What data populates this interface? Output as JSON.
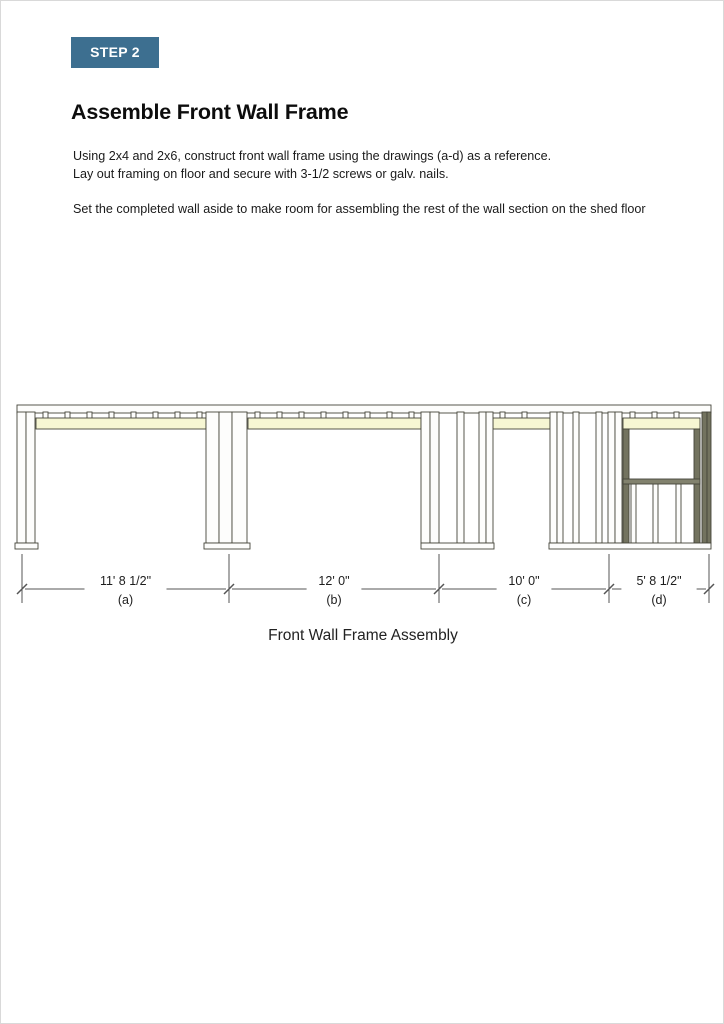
{
  "page": {
    "badge": "STEP 2",
    "title": "Assemble Front Wall Frame",
    "para1_line1": "Using 2x4 and 2x6, construct front wall frame using the drawings (a-d) as a reference.",
    "para1_line2": "Lay out framing on floor and secure with 3-1/2 screws or galv. nails.",
    "para2": "Set the completed wall aside to make room for assembling the rest of the wall section on the shed floor",
    "caption": "Front Wall Frame Assembly"
  },
  "colors": {
    "badge_bg": "#3d6f90",
    "member_fill": "#fdfdfc",
    "member_stroke": "#45453a",
    "header_fill": "#f6f6d3",
    "olive_fill": "#73735f",
    "sill_fill": "#82826e",
    "dim_line": "#555555",
    "dim_text": "#1d1d1d"
  },
  "drawing": {
    "top_plate": {
      "x": 16,
      "y": 404,
      "w": 694,
      "h": 8
    },
    "cripple_rows": [
      {
        "x1": 35,
        "x2": 205
      },
      {
        "x1": 247,
        "x2": 420
      },
      {
        "x1": 492,
        "x2": 549
      },
      {
        "x1": 622,
        "x2": 699
      }
    ],
    "headers": [
      {
        "x": 35,
        "w": 170
      },
      {
        "x": 247,
        "w": 173
      },
      {
        "x": 492,
        "w": 57
      },
      {
        "x": 622,
        "w": 77
      }
    ],
    "members": [
      {
        "x": 16,
        "w": 9
      },
      {
        "x": 25,
        "w": 9
      },
      {
        "x": 205,
        "w": 13
      },
      {
        "x": 218,
        "w": 13
      },
      {
        "x": 231,
        "w": 15
      },
      {
        "x": 420,
        "w": 9
      },
      {
        "x": 429,
        "w": 9
      },
      {
        "x": 456,
        "w": 7
      },
      {
        "x": 478,
        "w": 7
      },
      {
        "x": 485,
        "w": 7
      },
      {
        "x": 549,
        "w": 7
      },
      {
        "x": 556,
        "w": 6
      },
      {
        "x": 572,
        "w": 6
      },
      {
        "x": 595,
        "w": 6
      },
      {
        "x": 607,
        "w": 7
      },
      {
        "x": 614,
        "w": 7
      },
      {
        "x": 701,
        "w": 5,
        "f": "o"
      },
      {
        "x": 706,
        "w": 4,
        "f": "o"
      },
      {
        "x": 622,
        "w": 6,
        "f": "o",
        "y": 428,
        "h": 114
      },
      {
        "x": 693,
        "w": 6,
        "f": "o",
        "y": 428,
        "h": 114
      },
      {
        "x": 630,
        "w": 5,
        "y": 483,
        "h": 59
      },
      {
        "x": 652,
        "w": 5,
        "y": 483,
        "h": 59
      },
      {
        "x": 675,
        "w": 5,
        "y": 483,
        "h": 59
      }
    ],
    "sill": {
      "x": 622,
      "y": 478,
      "w": 77,
      "h": 5
    },
    "bottom_plates": [
      {
        "x": 14,
        "w": 23
      },
      {
        "x": 203,
        "w": 46
      },
      {
        "x": 420,
        "w": 73
      },
      {
        "x": 548,
        "w": 162
      }
    ],
    "dimensions": [
      {
        "x1": 21,
        "x2": 228,
        "value": "11' 8 1/2\"",
        "label": "(a)"
      },
      {
        "x1": 228,
        "x2": 438,
        "value": "12' 0\"",
        "label": "(b)"
      },
      {
        "x1": 438,
        "x2": 608,
        "value": "10' 0\"",
        "label": "(c)"
      },
      {
        "x1": 608,
        "x2": 708,
        "value": "5' 8 1/2\"",
        "label": "(d)"
      }
    ]
  }
}
